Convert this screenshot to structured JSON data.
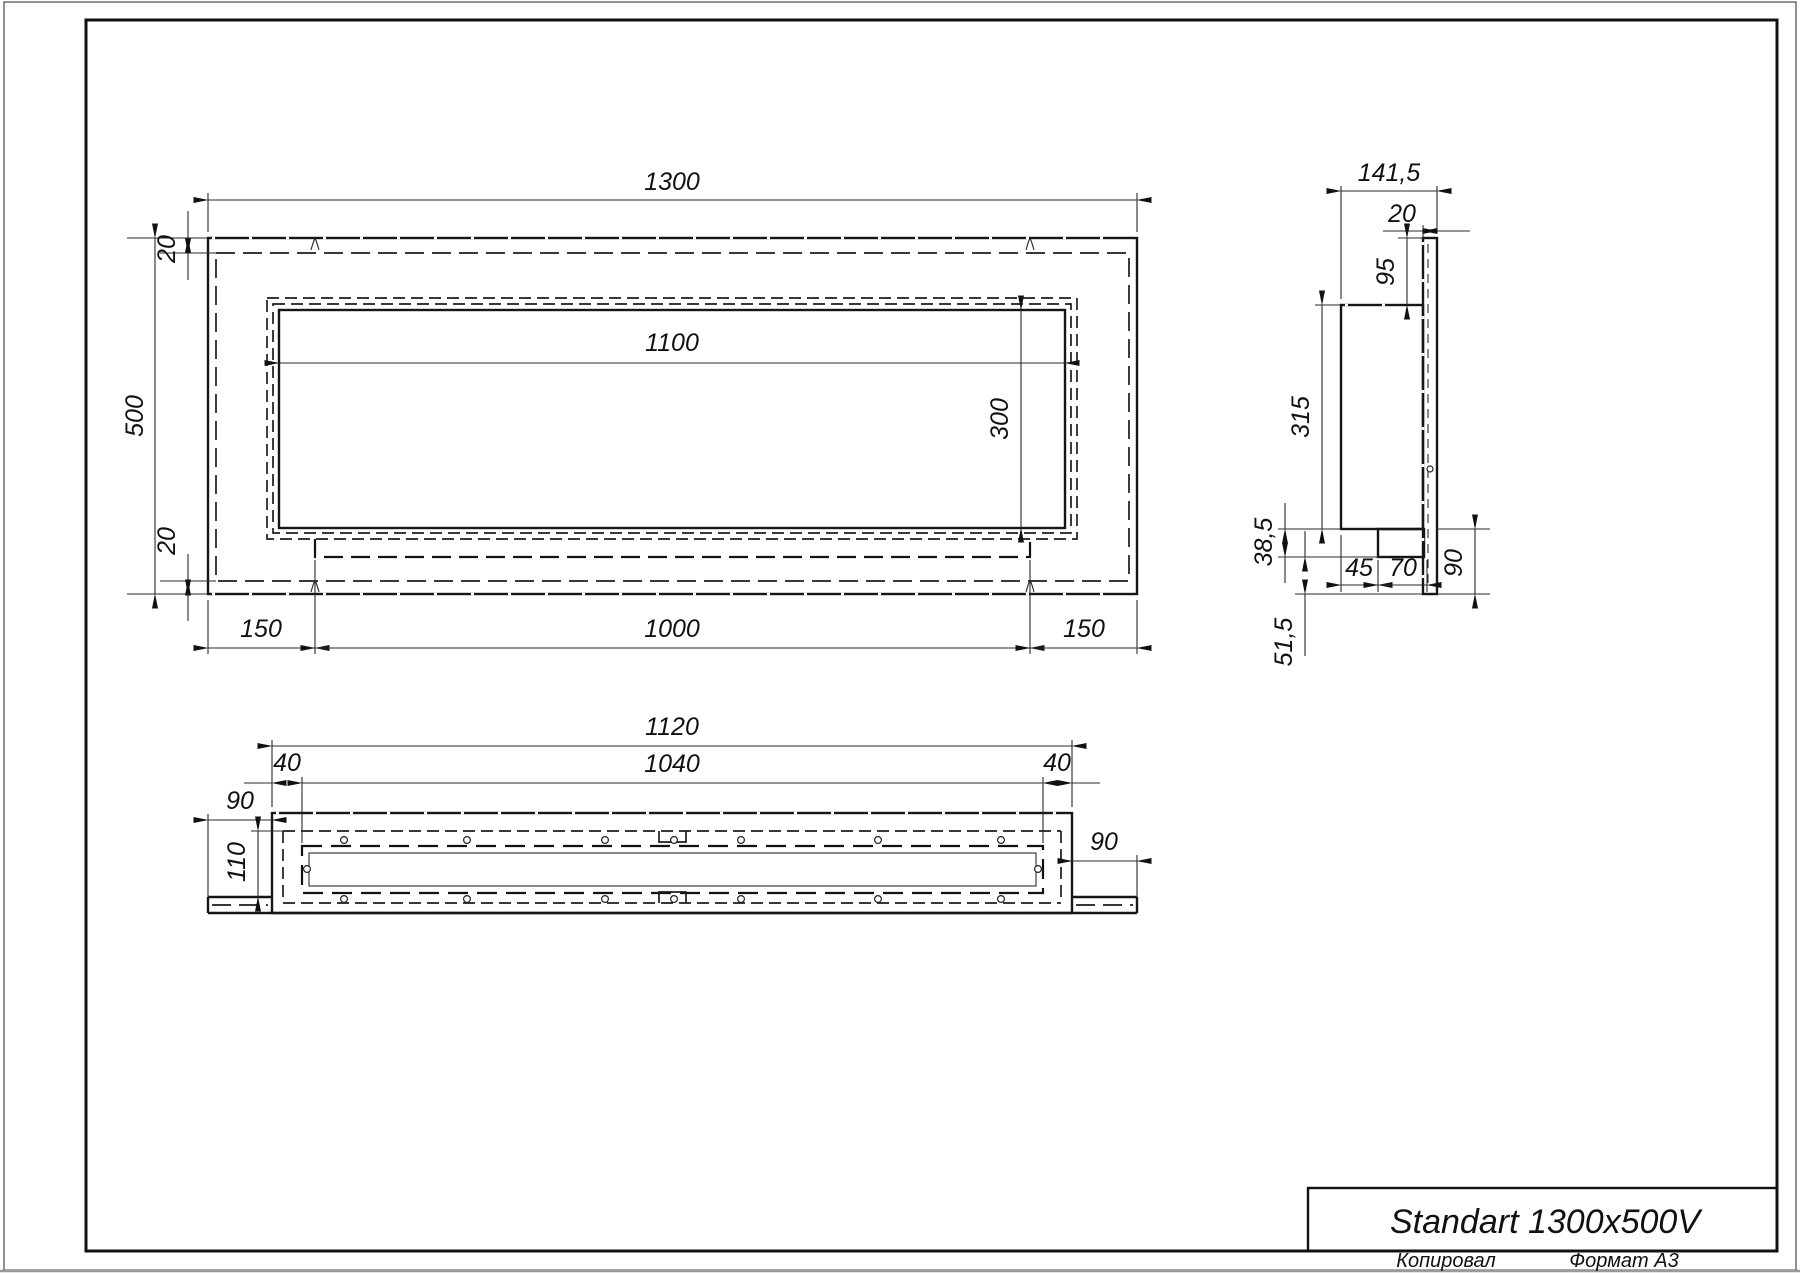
{
  "sheet": {
    "background": "#ffffff",
    "ink": "#161616",
    "copied_label": "Копировал",
    "format_label": "Формат А3"
  },
  "title_block": {
    "product_name": "Standart 1300x500V"
  },
  "front_view": {
    "dims": {
      "total_width": "1300",
      "total_height": "500",
      "top_inset": "20",
      "bottom_inset": "20",
      "opening_width": "1100",
      "opening_height": "300",
      "left_margin": "150",
      "burner_length": "1000",
      "right_margin": "150"
    }
  },
  "side_view": {
    "dims": {
      "total_depth": "141,5",
      "panel_thickness": "20",
      "top_offset": "95",
      "body_height": "315",
      "step_height": "38,5",
      "bottom_drop": "51,5",
      "inset": "45",
      "tray_depth": "70",
      "flange_height": "90"
    }
  },
  "bottom_view": {
    "dims": {
      "body_length": "1120",
      "opening_length": "1040",
      "left_inset": "40",
      "right_inset": "40",
      "left_flange": "90",
      "body_depth": "110",
      "right_flange": "90"
    }
  }
}
